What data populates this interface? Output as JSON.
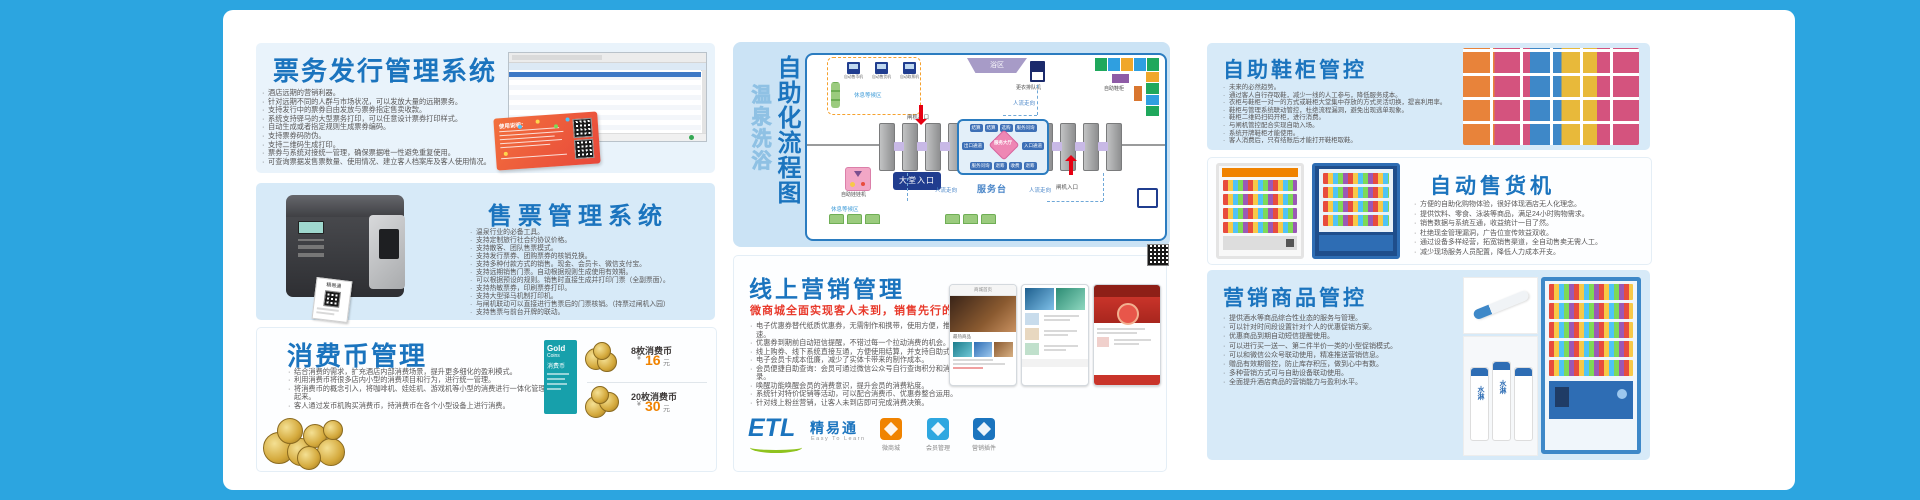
{
  "colors": {
    "accent": "#1B74BE",
    "red": "#E8392B",
    "teal": "#17A0AB",
    "orange": "#F08300",
    "page_blue": "#2CA5E0"
  },
  "cards": {
    "ticket_issue": {
      "title": "票务发行管理系统",
      "bullets": [
        "酒店远期的营销利器。",
        "针对远期不同的人群与市场状况，可以发放大量的远期票务。",
        "支持发行中的票券自由发放与票券指定售卖收款。",
        "系统支持驿马的大型票务打印，可以任意设计票券打印样式。",
        "自动生成或者指定规则生成票券编码。",
        "支持票券码防伪。",
        "支持二维码生成打印。",
        "票券与系统对接统一管理，确保票据唯一性避免重复使用。",
        "可查询票据发售票数量、使用情况、建立客人档案库及客人使用情况。"
      ],
      "ticket_note": "使用说明："
    },
    "ticket_sale": {
      "title": "售票管理系统",
      "printer_label": "精易通",
      "bullets": [
        "温泉行业的必备工具。",
        "支持定制旅行社合约协议价格。",
        "支持散客、团队售票模式。",
        "支持发行票券、团购票券的核销兑换。",
        "支持多种付款方式的销售。现金、会员卡、微信支付宝。",
        "支持远期销售门票。自动根据规则生成使用有效期。",
        "可以根据预设的规则。销售时直接生成并打印门票（全副票面）。",
        "支持热敏票券，印刷票券打印。",
        "支持大型驿马机制打印机。",
        "与闸机联动可以直接进行售票后的门票核销。（持票过闸机入园）",
        "支持售票与前台开牌的联动。"
      ]
    },
    "coin": {
      "title": "消费币管理",
      "bullets": [
        "结合消费的需求，扩充酒店内部消费场景，提升更多细化的盈利模式。",
        "利用消费币将很多店内小型的消费项目和行为，进行统一管理。",
        "将消费币的概念引入，将咖啡机、娃娃机、游戏机等小型的消费进行一体化管理起来。",
        "客人通过发币机购买消费币，持消费币在各个小型设备上进行消费。"
      ],
      "gold_card": {
        "word1": "Gold",
        "word2": "Coins",
        "name": "消费币"
      },
      "prices": [
        {
          "name": "8枚消费币",
          "currency": "¥",
          "price": "16",
          "unit": "元"
        },
        {
          "name": "20枚消费币",
          "currency": "¥",
          "price": "30",
          "unit": "元"
        }
      ]
    },
    "marketing": {
      "title": "线上营销管理",
      "subtitle": "微商城全面实现客人未到，销售先行的理念",
      "bullets": [
        "电子优惠券替代纸质优惠券，无需制作和携带，使用方便，推广迅速。",
        "优惠券到期前自动短信提醒，不错过每一个拉动消费的机会。",
        "线上购券、线下系统直接互通，方便使用结算，并支持自助式兑换。",
        "电子会员卡成本低廉，减少了实体卡带来的制作成本。",
        "会员便捷自助查询：会员可通过微信公众号自行查询积分和消费记录。",
        "唤醒功能唤醒会员的消费意识，提升会员的消费粘度。",
        "系统针对特价促销等活动，可以配合消费币、优惠券整合运用。",
        "针对线上粉丝营销，让客人未到店即可完成消费决策。"
      ],
      "phone1_header": "商城首页",
      "phone1_section": "最热商品",
      "logo": {
        "mark": "ETL",
        "name": "精易通",
        "tagline": "Easy To Learn"
      },
      "apps": [
        {
          "label": "微商城"
        },
        {
          "label": "会员管理"
        },
        {
          "label": "营销插件"
        }
      ]
    },
    "shoe": {
      "title": "自助鞋柜管控",
      "bullets": [
        "未来的必然趋势。",
        "通过客人自行存取鞋，减少一线的人工参与，降低服务成本。",
        "衣柜与鞋柜一对一的方式或鞋柜大堂集中存放的方式灵活切换，提高利用率。",
        "鞋柜与管理系统联动管控，杜绝流程漏洞，避免出现逃单现象。",
        "鞋柜二维码扫码开柜，进行消费。",
        "与闸机管控配合实现自助入场。",
        "系统开牌鞋柜才能使用。",
        "客人消费后，只有结账后才能打开鞋柜取鞋。"
      ]
    },
    "vending": {
      "title": "自动售货机",
      "bullets": [
        "方便的自助化购物体验，很好体现酒店无人化理念。",
        "提供饮料、零食、泳装等商品，满足24小时购物需求。",
        "销售数据与系统互通，收益统计一目了然。",
        "杜绝现金管理漏洞，广告位宣传效益双收。",
        "通过设备多样经营，拓宽销售渠道，全自动售卖无需人工。",
        "减少现场服务人员配置，降低人力成本开支。"
      ]
    },
    "merch": {
      "title": "营销商品管控",
      "bottle_label": "水淋",
      "bullets": [
        "提供酒水等商品综合性业态的服务与管理。",
        "可以针对时间段设置针对个人的优惠促销方案。",
        "优惠商品到期自动短信提醒使用。",
        "可以进行买一送一、第二件半价一类的小型促销模式。",
        "可以和微信公众号联动使用，精准推送营销信息。",
        "赠品有效期管控，防止库存积压，做到心中有数。",
        "多种营销方式可与自助设备联动使用。",
        "全面提升酒店商品的营销能力与盈利水平。"
      ]
    }
  },
  "flow": {
    "title_main": "自助化流程图",
    "title_sub": "温泉洗浴",
    "rest_area": "休息等候区",
    "rest_area_bottom": "休息等候区",
    "machines": [
      "自动售币机",
      "自动售货机",
      "自动取票机"
    ],
    "gate_exit": "闸机出口",
    "gate_entry": "闸机入口",
    "flow_dir": "人流走向",
    "bath": "浴区",
    "queue_machine": "更衣排队机",
    "shoe_cabinet": "自助鞋柜",
    "claw": "自助娃娃机",
    "service_desk": "服务台",
    "lobby_entry": "大堂入口",
    "center": {
      "top": [
        "结算",
        "结算",
        "选购",
        "服务问询"
      ],
      "left": "出口通道",
      "right": "入口通道",
      "middle": "服务大厅",
      "bottom": [
        "服务问询",
        "退筹",
        "收费",
        "退筹"
      ]
    }
  }
}
